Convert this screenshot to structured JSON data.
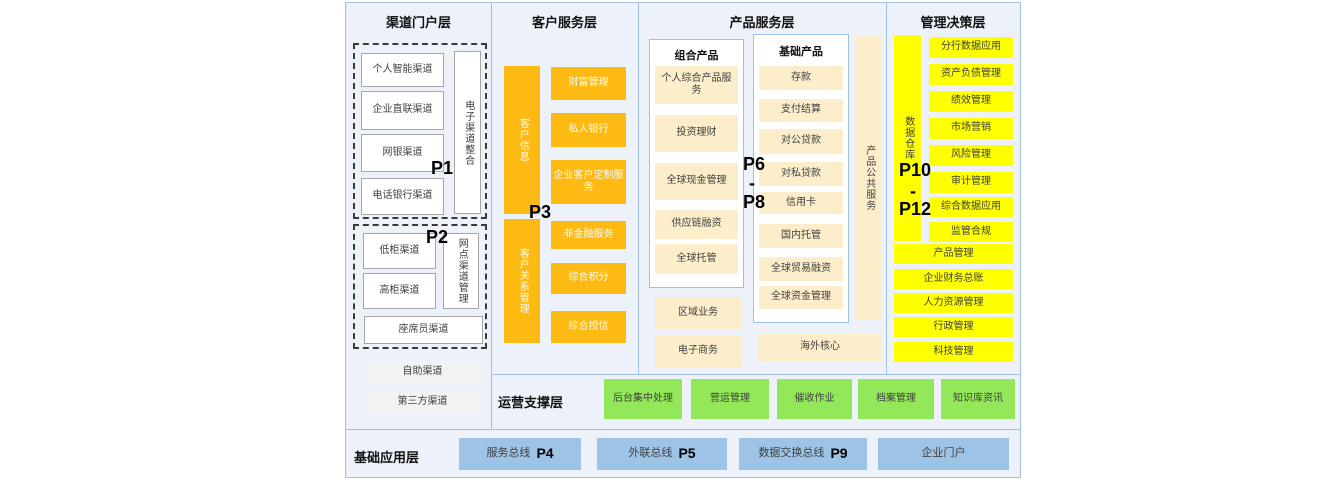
{
  "layers": {
    "channel_portal": {
      "title": "渠道门户层",
      "p1": "P1",
      "p2": "P2",
      "group1_boxes": [
        "个人智能渠道",
        "企业直联渠道",
        "网银渠道",
        "电话银行渠道"
      ],
      "group1_vertical": "电子渠道整合",
      "group2_boxes": [
        "低柜渠道",
        "高柜渠道"
      ],
      "group2_vertical": "网点渠道管理",
      "group2_wide": "座席员渠道",
      "bottom_boxes": [
        "自助渠道",
        "第三方渠道"
      ]
    },
    "customer_service": {
      "title": "客户服务层",
      "p3": "P3",
      "vertical_bars": [
        "客户信息",
        "客户关系管理"
      ],
      "boxes": [
        "财富管理",
        "私人银行",
        "企业客户定制服务",
        "非金融服务",
        "综合积分",
        "综合授信"
      ]
    },
    "product_service": {
      "title": "产品服务层",
      "p_range": [
        "P6",
        "-",
        "P8"
      ],
      "combo_panel": {
        "title": "组合产品",
        "boxes": [
          "个人综合产品服务",
          "投资理财",
          "全球现金管理",
          "供应链融资",
          "全球托管"
        ]
      },
      "basic_panel": {
        "title": "基础产品",
        "boxes": [
          "存款",
          "支付结算",
          "对公贷款",
          "对私贷款",
          "信用卡",
          "国内托管",
          "全球贸易融资",
          "全球资金管理"
        ]
      },
      "public_vertical": "产品公共服务",
      "left_bottom_boxes": [
        "区域业务",
        "电子商务"
      ],
      "overseas_box": "海外核心"
    },
    "management_decision": {
      "title": "管理决策层",
      "p_range": [
        "P10",
        "-",
        "P12"
      ],
      "warehouse_vertical": "数据仓库",
      "narrow_boxes": [
        "分行数据应用",
        "资产负债管理",
        "绩效管理",
        "市场营销",
        "风险管理",
        "审计管理",
        "综合数据应用",
        "监管合规"
      ],
      "wide_boxes": [
        "产品管理",
        "企业财务总账",
        "人力资源管理",
        "行政管理",
        "科技管理"
      ]
    },
    "operation_support": {
      "title": "运营支撑层",
      "boxes": [
        "后台集中处理",
        "营运管理",
        "催收作业",
        "档案管理",
        "知识库资讯"
      ]
    },
    "basic_application": {
      "title": "基础应用层",
      "boxes": [
        {
          "label": "服务总线",
          "p": "P4"
        },
        {
          "label": "外联总线",
          "p": "P5"
        },
        {
          "label": "数据交换总线",
          "p": "P9"
        },
        {
          "label": "企业门户",
          "p": ""
        }
      ]
    }
  },
  "colors": {
    "background": "#edf2fa",
    "border_blue": "#a3c0de",
    "orange": "#fdba12",
    "cream": "#fdeecb",
    "yellow": "#ffff00",
    "green": "#92e858",
    "blue_box": "#9dc3e6",
    "gray_box": "#f2f2f2",
    "white_box_border": "#a6a6a6"
  }
}
